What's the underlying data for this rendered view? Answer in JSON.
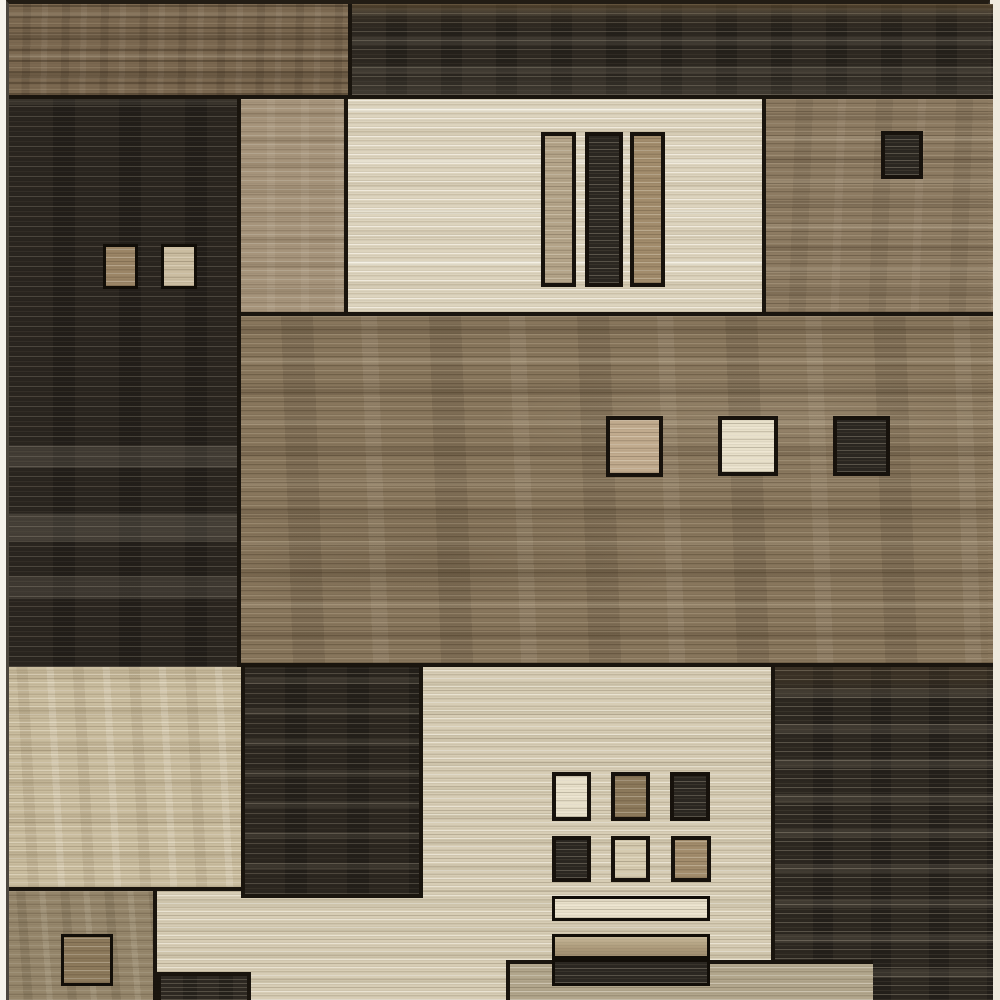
{
  "description": "Product photo of a modern geometric color-block area rug in browns, taupe, charcoal and cream, shown flat, full-frame, with thin white backdrop margins on left and right edges.",
  "palette": {
    "seam": "#1a150e",
    "backdrop_left": "#f6f3ec",
    "backdrop_right": "#efeade",
    "charcoal": "#2b2620",
    "brown": "#7b6850",
    "taupe": "#88765c",
    "beige": "#d7cdb5",
    "cream": "#ddd4be"
  },
  "canvas": {
    "width": 1000,
    "height": 1000
  },
  "rug": {
    "x": 6,
    "width": 984
  },
  "blocks": [
    {
      "name": "block-top-left-brown",
      "x": 6,
      "y": 0,
      "w": 339,
      "h": 95,
      "tex": "brownTop",
      "seams": [
        "b"
      ]
    },
    {
      "name": "block-top-right-charcoal",
      "x": 345,
      "y": 0,
      "w": 645,
      "h": 95,
      "tex": "darkTop",
      "seams": [
        "b",
        "l"
      ]
    },
    {
      "name": "block-left-charcoal",
      "x": 6,
      "y": 95,
      "w": 232,
      "h": 568,
      "tex": "darkLeft",
      "seams": [
        "r"
      ]
    },
    {
      "name": "block-taupe-column",
      "x": 238,
      "y": 95,
      "w": 107,
      "h": 217,
      "tex": "taupeCol",
      "seams": [
        "r",
        "b"
      ]
    },
    {
      "name": "block-cream-panel",
      "x": 345,
      "y": 95,
      "w": 418,
      "h": 217,
      "tex": "cream",
      "seams": [
        "b",
        "r"
      ]
    },
    {
      "name": "block-right-brown",
      "x": 763,
      "y": 95,
      "w": 227,
      "h": 217,
      "tex": "brownRight",
      "seams": [
        "b"
      ]
    },
    {
      "name": "block-middle-taupe",
      "x": 238,
      "y": 312,
      "w": 752,
      "h": 351,
      "tex": "middle",
      "seams": [
        "b"
      ]
    },
    {
      "name": "block-bottom-left-beige",
      "x": 6,
      "y": 663,
      "w": 232,
      "h": 224,
      "tex": "beigeMottled",
      "seams": [
        "b"
      ]
    },
    {
      "name": "block-bottom-left-brown",
      "x": 6,
      "y": 887,
      "w": 148,
      "h": 113,
      "tex": "brownStreak",
      "seams": [
        "r"
      ]
    },
    {
      "name": "block-bottom-beige-lower",
      "x": 154,
      "y": 887,
      "w": 614,
      "h": 113,
      "tex": "beigeLines",
      "seams": []
    },
    {
      "name": "block-bottom-beige-upper",
      "x": 420,
      "y": 663,
      "w": 348,
      "h": 224,
      "tex": "beigeLines",
      "seams": []
    },
    {
      "name": "block-bottom-charcoal-left",
      "x": 238,
      "y": 663,
      "w": 182,
      "h": 231,
      "tex": "darkD2",
      "seams": [
        "l",
        "r",
        "b"
      ]
    },
    {
      "name": "block-bottom-right-charcoal",
      "x": 768,
      "y": 663,
      "w": 222,
      "h": 337,
      "tex": "darkD3",
      "seams": [
        "l"
      ]
    },
    {
      "name": "strip-taupe-bottom",
      "x": 503,
      "y": 956,
      "w": 367,
      "h": 44,
      "tex": "taupeStrip",
      "seams": [
        "t",
        "l"
      ]
    },
    {
      "name": "strip-charcoal-bottom",
      "x": 154,
      "y": 968,
      "w": 94,
      "h": 32,
      "tex": "darkStrip",
      "seams": [
        "t",
        "l",
        "r"
      ]
    },
    {
      "name": "square-left-panel-brown",
      "x": 100,
      "y": 240,
      "w": 35,
      "h": 45,
      "tex": "sqBrown",
      "framed": "thin"
    },
    {
      "name": "square-left-panel-cream",
      "x": 158,
      "y": 240,
      "w": 36,
      "h": 45,
      "tex": "sqCream",
      "framed": "thin"
    },
    {
      "name": "bar-cream-panel-tan-1",
      "x": 538,
      "y": 128,
      "w": 35,
      "h": 155,
      "tex": "sqTanGray",
      "framed": "mid"
    },
    {
      "name": "bar-cream-panel-charcoal",
      "x": 582,
      "y": 128,
      "w": 38,
      "h": 155,
      "tex": "sqDark",
      "framed": "mid"
    },
    {
      "name": "bar-cream-panel-tan-2",
      "x": 627,
      "y": 128,
      "w": 35,
      "h": 155,
      "tex": "sqTanBrown",
      "framed": "mid"
    },
    {
      "name": "square-right-brown-charcoal",
      "x": 878,
      "y": 127,
      "w": 42,
      "h": 48,
      "tex": "sqDark",
      "framed": "mid"
    },
    {
      "name": "square-middle-tan",
      "x": 603,
      "y": 412,
      "w": 57,
      "h": 61,
      "tex": "sqTan",
      "framed": "mid"
    },
    {
      "name": "square-middle-ivory",
      "x": 715,
      "y": 412,
      "w": 60,
      "h": 60,
      "tex": "sqIvory",
      "framed": "mid"
    },
    {
      "name": "square-middle-charcoal",
      "x": 830,
      "y": 412,
      "w": 57,
      "h": 60,
      "tex": "sqDark",
      "framed": "mid"
    },
    {
      "name": "square-bottom-left-brown",
      "x": 58,
      "y": 930,
      "w": 52,
      "h": 52,
      "tex": "sqBrownDk",
      "framed": "thin"
    },
    {
      "name": "grid-square-r1c1-ivory",
      "x": 549,
      "y": 768,
      "w": 39,
      "h": 49,
      "tex": "sqIvory",
      "framed": "mid"
    },
    {
      "name": "grid-square-r1c2-brown",
      "x": 608,
      "y": 768,
      "w": 39,
      "h": 49,
      "tex": "sqBrownDk",
      "framed": "mid"
    },
    {
      "name": "grid-square-r1c3-charcoal",
      "x": 667,
      "y": 768,
      "w": 40,
      "h": 49,
      "tex": "sqDark",
      "framed": "mid"
    },
    {
      "name": "grid-square-r2c1-charcoal",
      "x": 549,
      "y": 832,
      "w": 39,
      "h": 46,
      "tex": "sqDark",
      "framed": "mid"
    },
    {
      "name": "grid-square-r2c2-beige",
      "x": 608,
      "y": 832,
      "w": 39,
      "h": 46,
      "tex": "sqBeige",
      "framed": "mid"
    },
    {
      "name": "grid-square-r2c3-brown",
      "x": 668,
      "y": 832,
      "w": 40,
      "h": 46,
      "tex": "sqTanBrown",
      "framed": "mid"
    },
    {
      "name": "bar-bottom-ivory",
      "x": 549,
      "y": 892,
      "w": 158,
      "h": 25,
      "tex": "sqIvory",
      "framed": "thin"
    },
    {
      "name": "bar-bottom-tan",
      "x": 549,
      "y": 930,
      "w": 158,
      "h": 25,
      "tex": "sqKhaki",
      "framed": "thin"
    },
    {
      "name": "bar-bottom-charcoal",
      "x": 549,
      "y": 955,
      "w": 158,
      "h": 27,
      "tex": "sqDark",
      "framed": "thin"
    }
  ]
}
